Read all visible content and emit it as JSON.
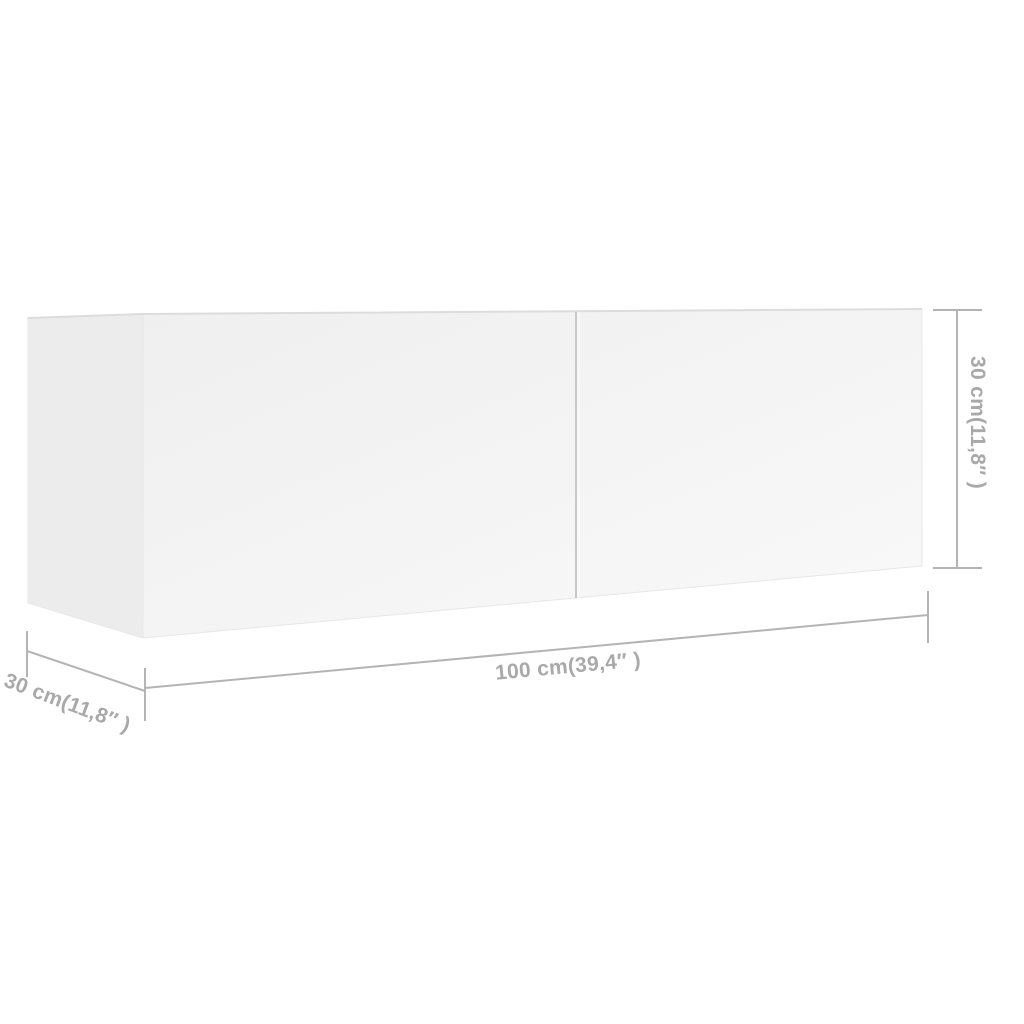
{
  "diagram": {
    "kind": "furniture-dimension-diagram",
    "dimensions": {
      "width_label": "100 cm(39,4″ )",
      "depth_label": "30 cm(11,8″ )",
      "height_label": "30 cm(11,8″ )"
    },
    "colors": {
      "background": "#ffffff",
      "dimension_line": "#b4b4b4",
      "dimension_text": "#a9a9a9",
      "front_face_top": "#efefef",
      "front_face_bottom": "#f9f9f9",
      "side_face": "#ececec",
      "top_edge": "#dcdcdc",
      "face_edge": "#e7e7e7",
      "door_seam": "#c8c8c8"
    }
  }
}
